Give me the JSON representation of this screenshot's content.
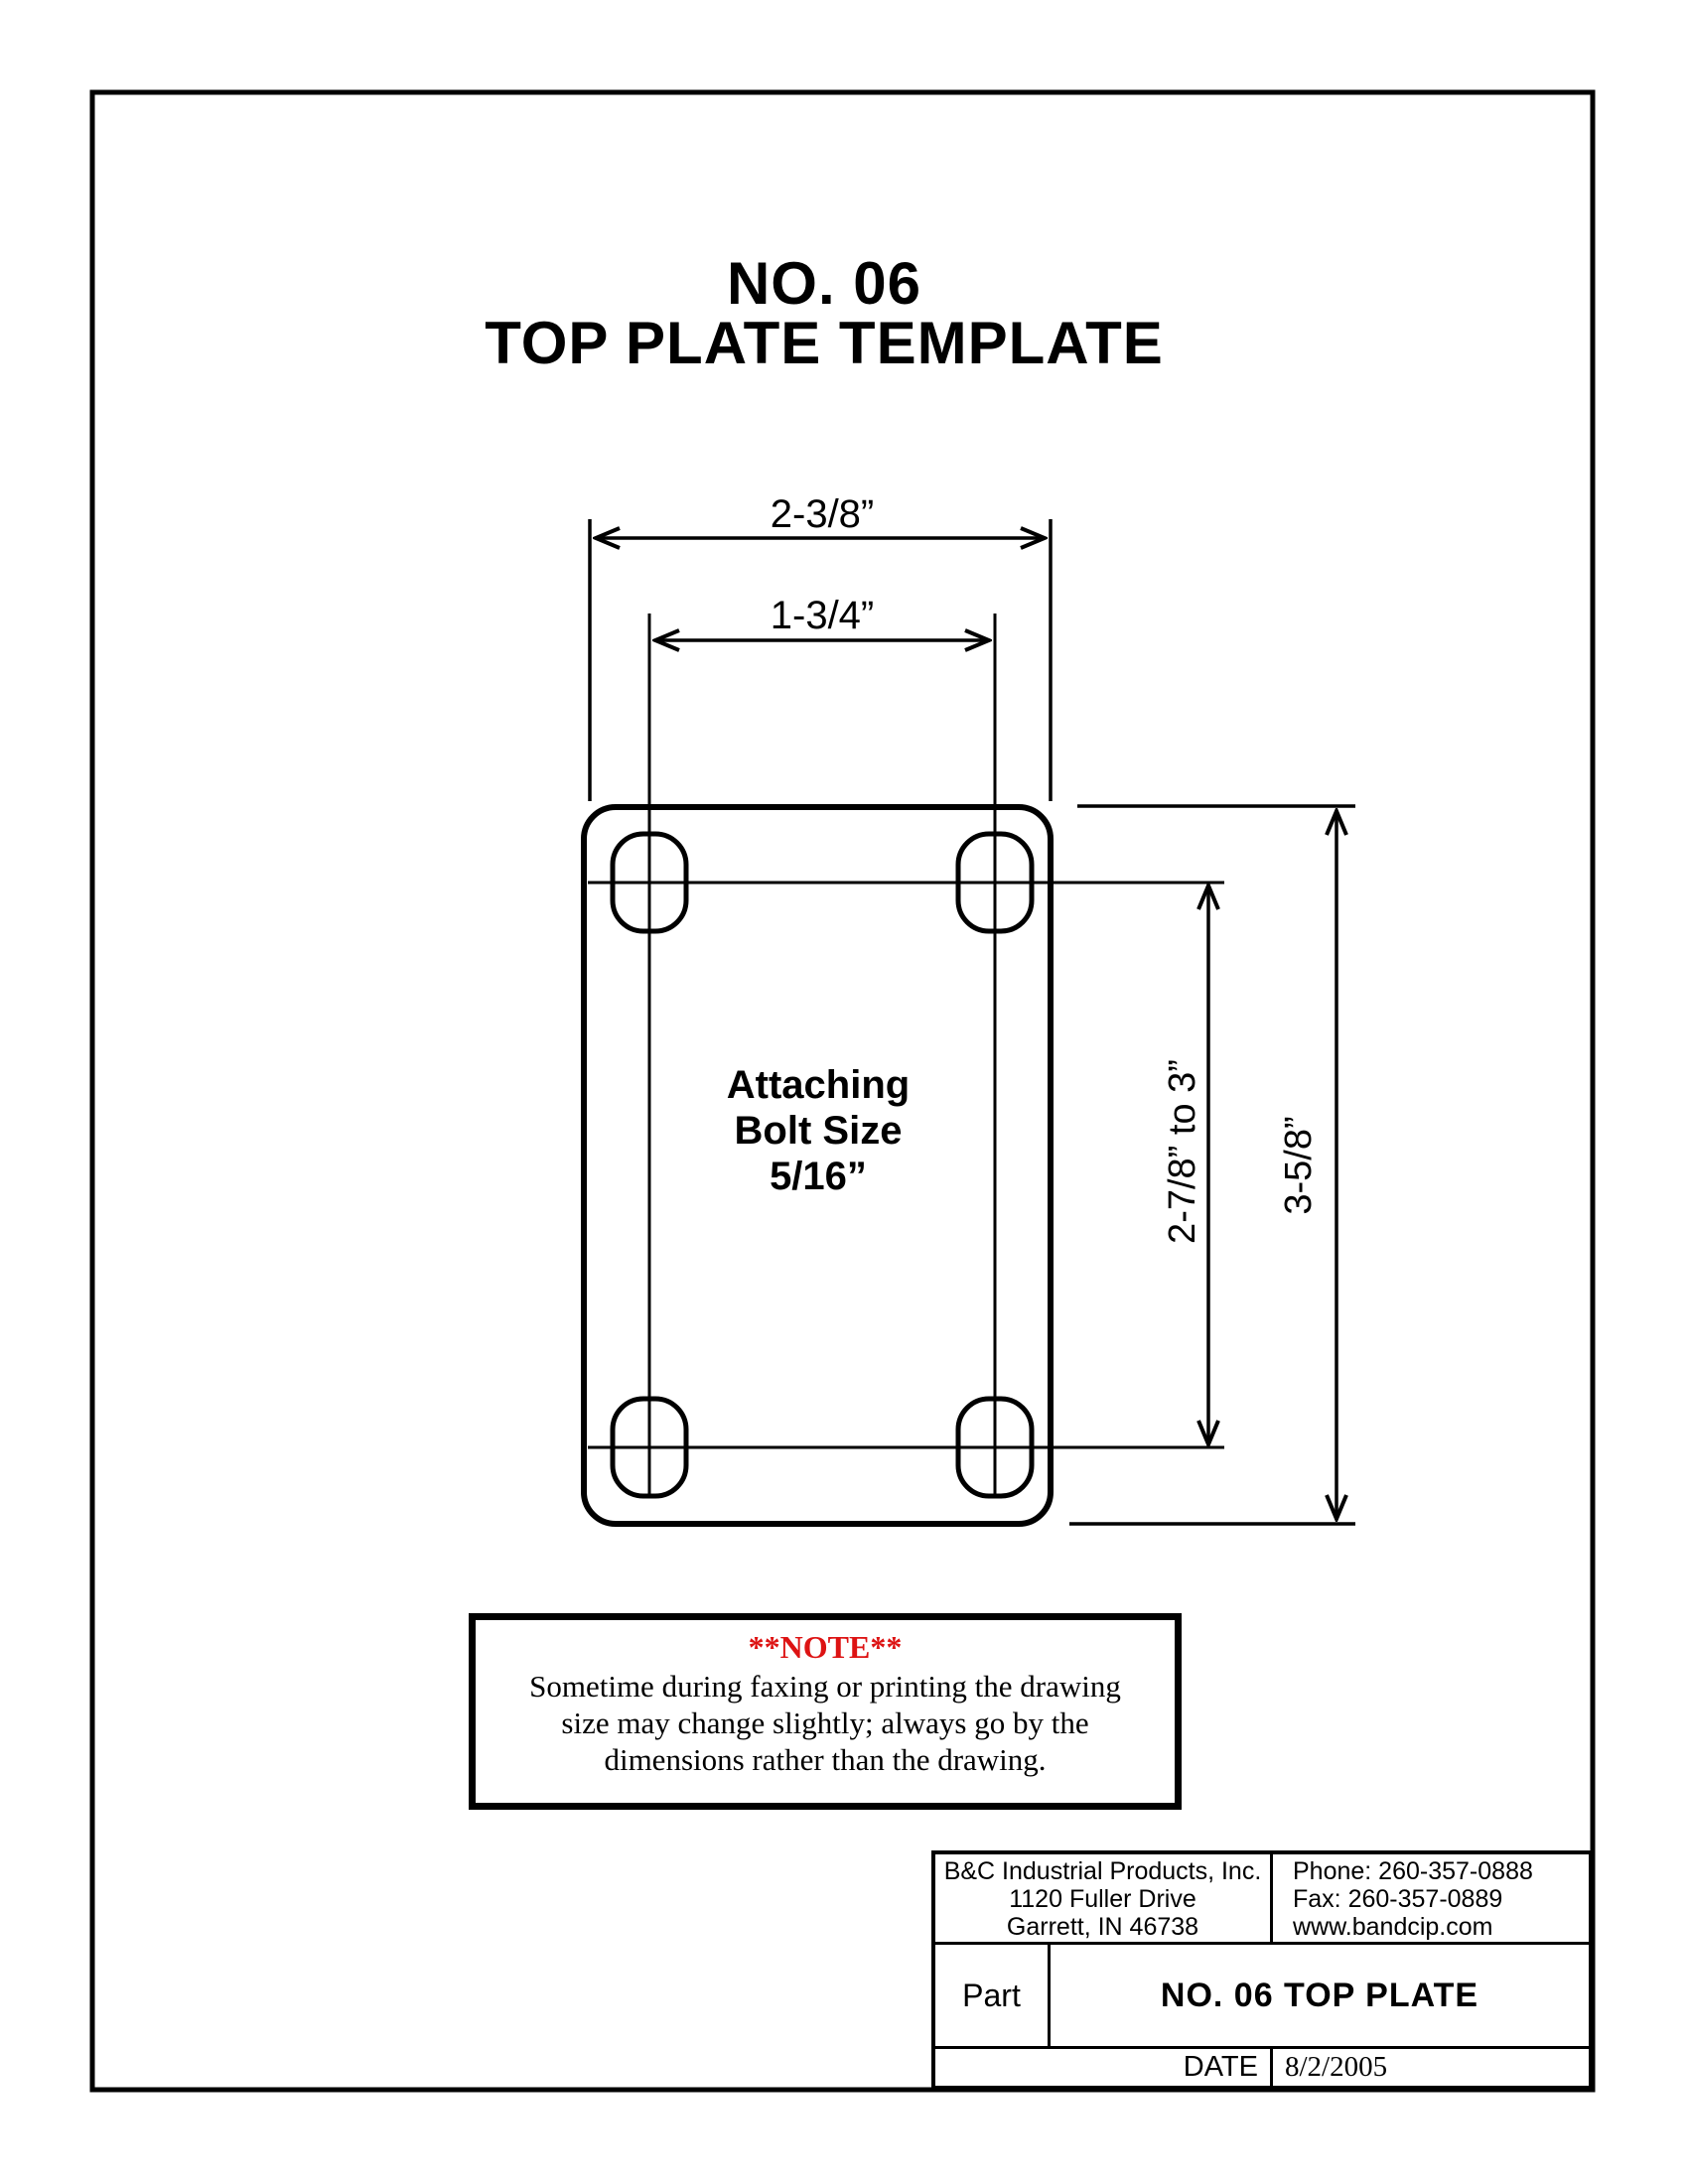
{
  "page": {
    "title_line1": "NO. 06",
    "title_line2": "TOP PLATE TEMPLATE"
  },
  "drawing": {
    "dim_plate_width": "2-3/8”",
    "dim_bolt_spacing_width": "1-3/4”",
    "dim_bolt_spacing_height": "2-7/8” to 3”",
    "dim_plate_height": "3-5/8”",
    "plate_label_line1": "Attaching",
    "plate_label_line2": "Bolt Size",
    "plate_label_line3": "5/16”",
    "line_color": "#000000"
  },
  "note": {
    "heading": "**NOTE**",
    "heading_color": "#dd1313",
    "line1": "Sometime during faxing or printing the drawing",
    "line2": "size may change slightly; always go by the",
    "line3": "dimensions rather than the drawing."
  },
  "title_block": {
    "company": {
      "name": "B&C Industrial Products, Inc.",
      "address_line1": "1120 Fuller Drive",
      "address_line2": "Garrett, IN  46738"
    },
    "contact": {
      "phone": "Phone: 260-357-0888",
      "fax": "Fax: 260-357-0889",
      "website": "www.bandcip.com"
    },
    "part_label": "Part",
    "part_value": "NO. 06 TOP PLATE",
    "date_label": "DATE",
    "date_value": "8/2/2005"
  }
}
